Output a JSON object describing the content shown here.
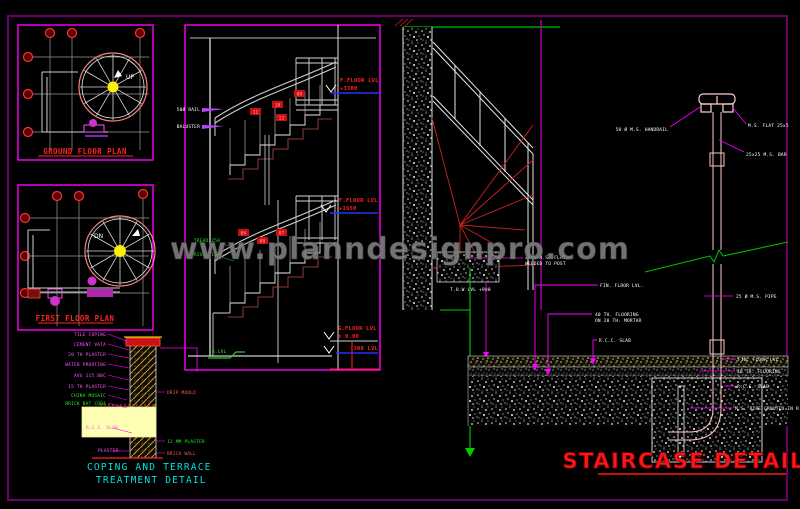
{
  "colors": {
    "magenta": "#ff00ff",
    "red": "#ff2222",
    "green": "#22dd22",
    "cyan": "#00e0e0",
    "yellow": "#ffef00",
    "level_line_blue": "#2233ff",
    "gray_line": "#cfcfcf",
    "watermark_gray": "#7f7f7f",
    "title_red": "#ff1515"
  },
  "watermark": {
    "text": "www.planndesignpro.com"
  },
  "title": {
    "text": "STAIRCASE DETAILS"
  },
  "ground_plan": {
    "label": "GROUND FLOOR PLAN",
    "direction": "UP"
  },
  "first_plan": {
    "label": "FIRST FLOOR PLAN",
    "direction": "DN"
  },
  "coping": {
    "caption1": "COPING AND TERRACE",
    "caption2": "TREATMENT DETAIL",
    "left_labels": [
      "TILE COPING",
      "CEMENT VATA",
      "20 TH PLASTER",
      "WATER PROOFING",
      "AVG 115 BBC",
      "15 TH PLASTER"
    ],
    "green_labels": [
      "CHINA MOSAIC",
      "BRICK BAT COBA"
    ],
    "slab_label": "R.C.C. SLAB",
    "bottom_label": "PLASTER",
    "right_labels": [
      "DRIP MOULD",
      "12 MM PLASTER",
      "BRICK WALL"
    ]
  },
  "section": {
    "level1a": "F.FLOOR LVL",
    "level1b": "+3300",
    "level2a": "F.FLOOR LVL",
    "level2b": "+1650",
    "level3a": "G.FLOOR LVL",
    "level3b": "± 0.00",
    "level4": "-300 LVL",
    "gl": "G.LVL",
    "left_label1": "50Ø RAIL",
    "left_label2": "BALUSTER",
    "green_label1": "TREAD 250",
    "green_label2": "RISER 165",
    "tags_upper": [
      "09",
      "10",
      "11",
      "12"
    ],
    "tags_lower": [
      "06",
      "07",
      "08"
    ]
  },
  "winder": {
    "flat_label1": "40x5 M.S. FLAT",
    "flat_label2": "WELDED TO POST",
    "tow_label": "T.O.W LVL +900"
  },
  "slab": {
    "label1": "FIN. FLOOR LVL.",
    "label2a": "40 TH. FLOORING",
    "label2b": "ON 20 TH. MORTAR",
    "label3": "R.C.C. SLAB"
  },
  "baluster": {
    "handrail": "50 Ø M.S. HANDRAIL",
    "flat": "M.S. FLAT 25x5",
    "bar": "25x25 M.S. BAR",
    "pipe": "25 Ø M.S. PIPE",
    "ffl": "FIN. FLOOR LVL.",
    "flooring": "40 TH. FLOORING",
    "slab": "R.C.C. SLAB",
    "anchor": "M.S. PIPE GROUTED IN R.C.C."
  }
}
